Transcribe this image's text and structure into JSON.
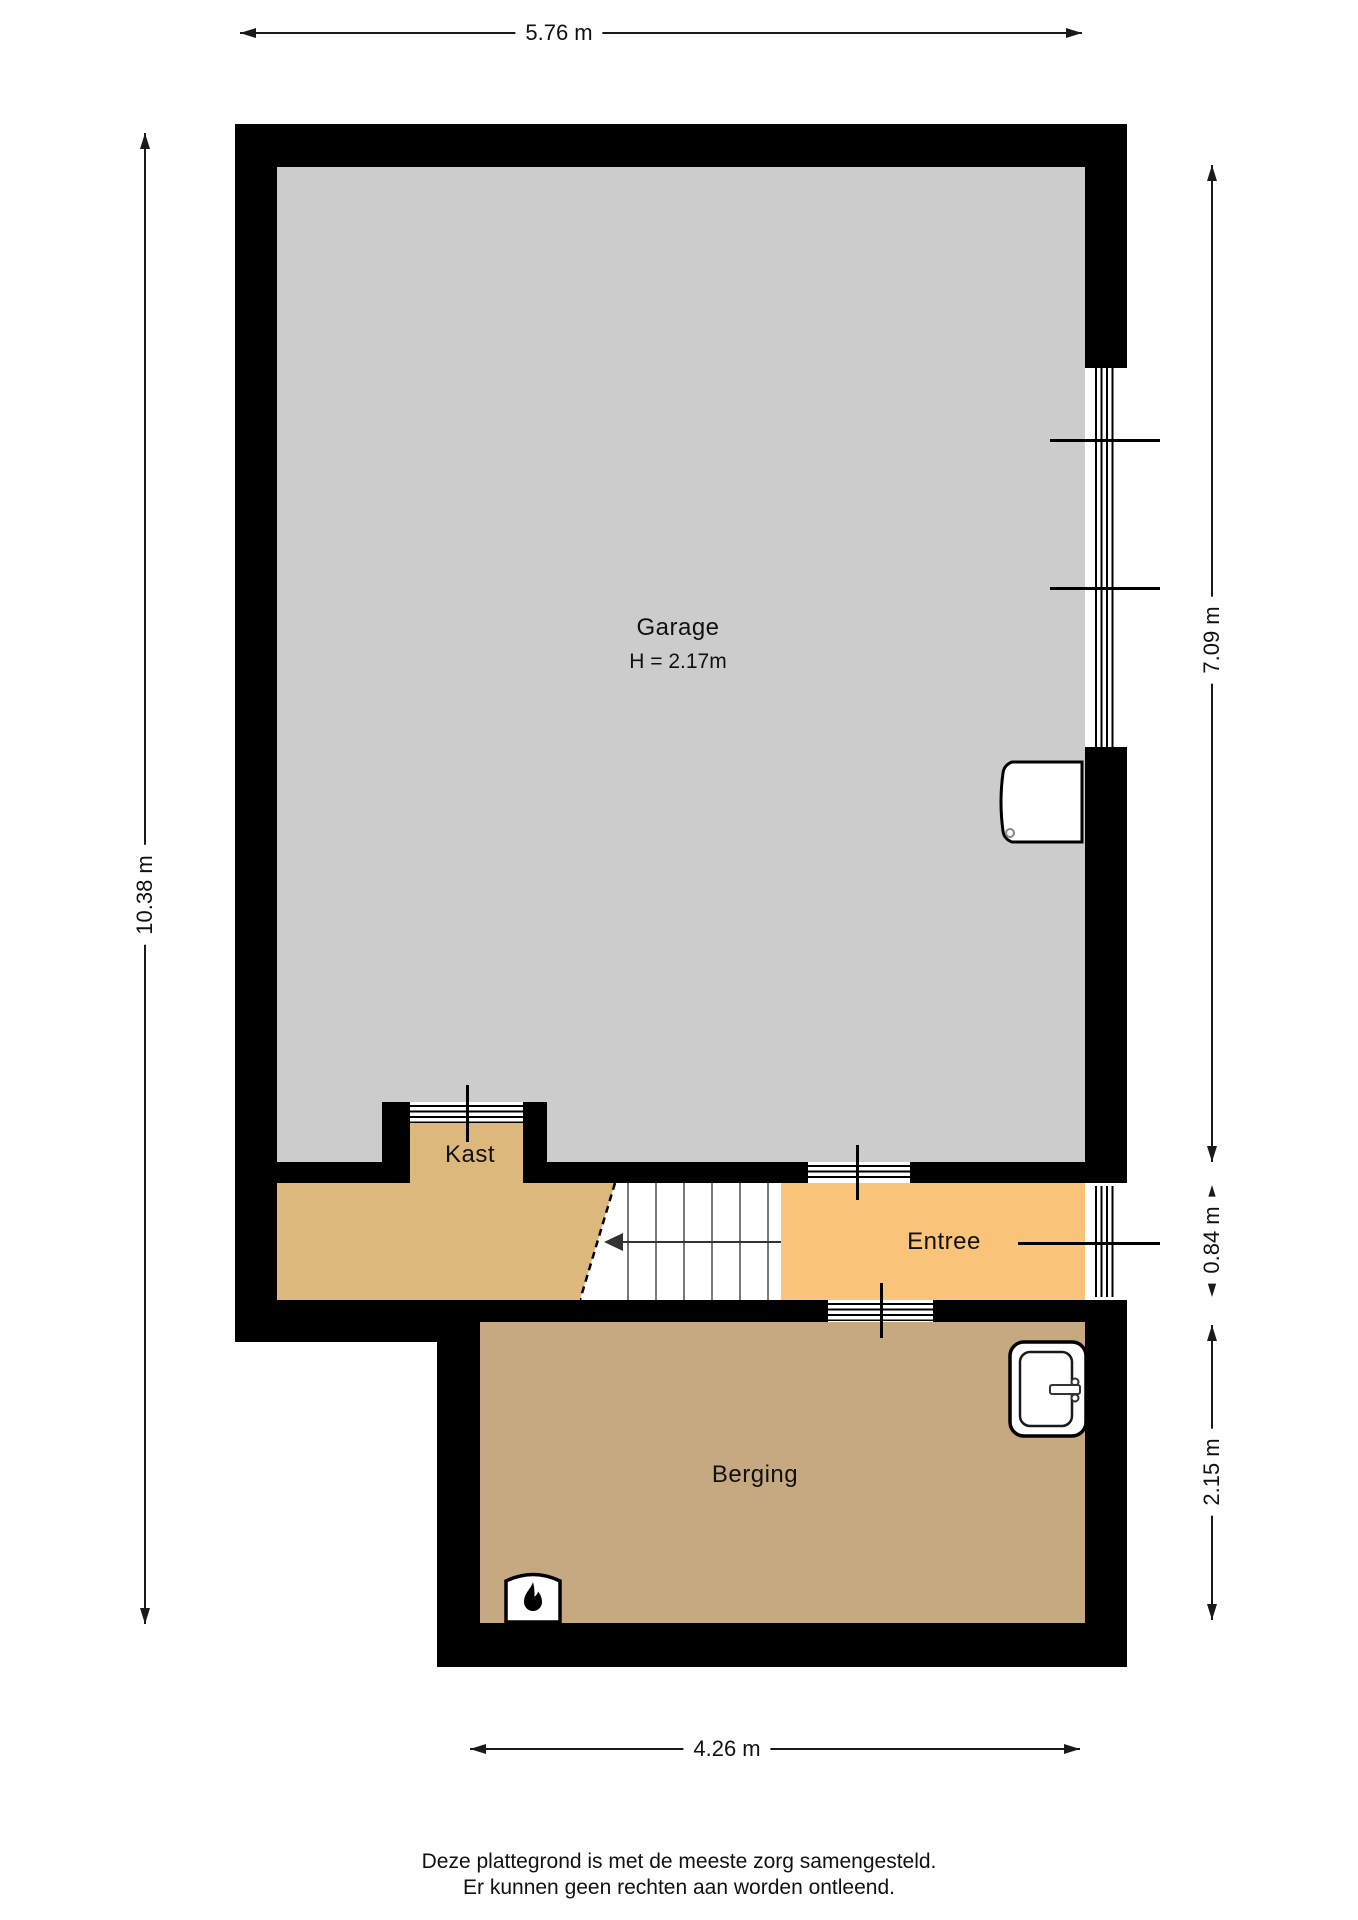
{
  "plan": {
    "rooms": [
      {
        "name": "Garage",
        "sub": "H = 2.17m",
        "fill": "#cccccc"
      },
      {
        "name": "Kast",
        "fill": "#ddb87d"
      },
      {
        "name": "Entree",
        "fill": "#f9c379"
      },
      {
        "name": "Berging",
        "fill": "#c6a981"
      }
    ],
    "wall_color": "#000000",
    "dimensions": {
      "top": "5.76 m",
      "left": "10.38 m",
      "right_top": "7.09 m",
      "right_mid": "0.84 m",
      "right_bottom": "2.15 m",
      "bottom": "4.26 m"
    },
    "icons": [
      {
        "name": "flame-icon"
      },
      {
        "name": "sink-icon"
      },
      {
        "name": "stairs-direction-arrow"
      }
    ]
  },
  "footer": {
    "line1": "Deze plattegrond is met de meeste zorg samengesteld.",
    "line2": "Er kunnen geen rechten aan worden ontleend."
  }
}
